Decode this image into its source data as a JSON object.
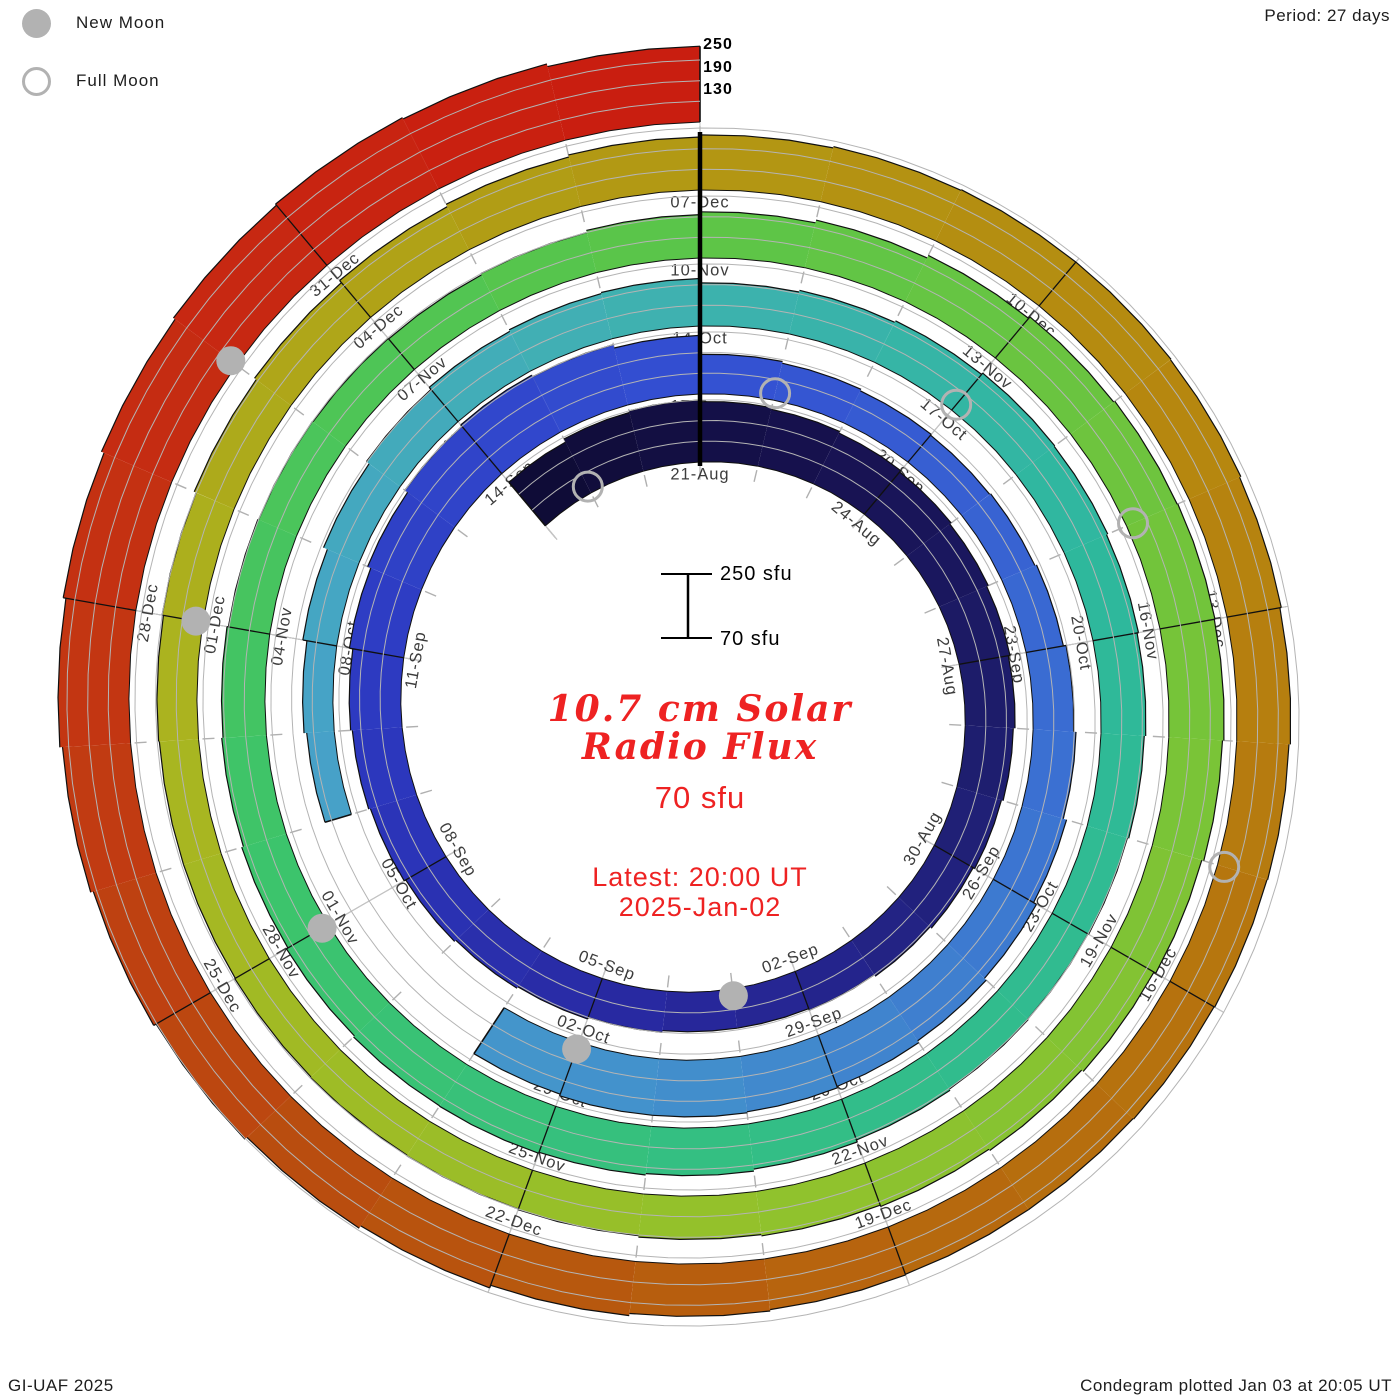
{
  "legend": {
    "new_moon": "New Moon",
    "full_moon": "Full Moon"
  },
  "period_label": "Period: 27 days",
  "credit": "GI-UAF 2025",
  "plotted": "Condegram plotted Jan 03 at 20:05 UT",
  "center": {
    "title_line1": "10.7 cm Solar",
    "title_line2": "Radio Flux",
    "current_value": "70 sfu",
    "latest_line1": "Latest: 20:00 UT",
    "latest_line2": "2025-Jan-02"
  },
  "scale_bar": {
    "top": "250 sfu",
    "bottom": "70 sfu"
  },
  "radial_axis_labels": [
    "250",
    "190",
    "130"
  ],
  "colors": {
    "accent_red_text": "#ee2222",
    "moon_gray": "#b2b2b2",
    "grid_gray": "#b4b4b4",
    "label_gray": "#3c3c3c"
  },
  "chart_data": {
    "type": "spiral",
    "subtype": "condegram",
    "title": "10.7 cm Solar Radio Flux",
    "period_days": 27,
    "start_date": "2024-08-18",
    "first_labeled_date": "2024-08-21",
    "end_date": "2025-01-02",
    "flux_axis": {
      "min": 70,
      "max": 250,
      "gridlines": [
        130,
        190,
        250
      ],
      "unit": "sfu"
    },
    "day_offset_of_first_value": -3,
    "flux_sfu": [
      235,
      245,
      250,
      245,
      240,
      235,
      230,
      225,
      220,
      215,
      210,
      205,
      200,
      195,
      190,
      185,
      185,
      190,
      195,
      200,
      205,
      210,
      215,
      220,
      230,
      240,
      250,
      255,
      250,
      240,
      185,
      180,
      175,
      172,
      175,
      180,
      188,
      195,
      205,
      215,
      222,
      228,
      232,
      235,
      235,
      230,
      null,
      null,
      null,
      150,
      158,
      170,
      182,
      192,
      200,
      205,
      208,
      195,
      200,
      205,
      210,
      208,
      204,
      200,
      196,
      192,
      190,
      192,
      196,
      202,
      208,
      212,
      215,
      214,
      210,
      205,
      200,
      196,
      192,
      190,
      188,
      186,
      190,
      196,
      204,
      212,
      220,
      226,
      230,
      232,
      230,
      226,
      220,
      214,
      208,
      204,
      200,
      196,
      192,
      190,
      188,
      186,
      184,
      184,
      186,
      190,
      196,
      202,
      210,
      218,
      224,
      230,
      234,
      236,
      236,
      234,
      230,
      226,
      222,
      220,
      218,
      216,
      216,
      218,
      222,
      228,
      236,
      244,
      252,
      260,
      268,
      276,
      284,
      292,
      298,
      302,
      298,
      290
    ],
    "date_labels": [
      {
        "day": 0,
        "text": "21-Aug"
      },
      {
        "day": 3,
        "text": "24-Aug"
      },
      {
        "day": 6,
        "text": "27-Aug"
      },
      {
        "day": 9,
        "text": "30-Aug"
      },
      {
        "day": 12,
        "text": "02-Sep"
      },
      {
        "day": 15,
        "text": "05-Sep"
      },
      {
        "day": 18,
        "text": "08-Sep"
      },
      {
        "day": 21,
        "text": "11-Sep"
      },
      {
        "day": 24,
        "text": "14-Sep"
      },
      {
        "day": 27,
        "text": "17-Sep"
      },
      {
        "day": 30,
        "text": "20-Sep"
      },
      {
        "day": 33,
        "text": "23-Sep"
      },
      {
        "day": 36,
        "text": "26-Sep"
      },
      {
        "day": 39,
        "text": "29-Sep"
      },
      {
        "day": 42,
        "text": "02-Oct"
      },
      {
        "day": 45,
        "text": "05-Oct"
      },
      {
        "day": 48,
        "text": "08-Oct"
      },
      {
        "day": 51,
        "text": "11-Oct"
      },
      {
        "day": 54,
        "text": "14-Oct"
      },
      {
        "day": 57,
        "text": "17-Oct"
      },
      {
        "day": 60,
        "text": "20-Oct"
      },
      {
        "day": 63,
        "text": "23-Oct"
      },
      {
        "day": 66,
        "text": "26-Oct"
      },
      {
        "day": 69,
        "text": "29-Oct"
      },
      {
        "day": 72,
        "text": "01-Nov"
      },
      {
        "day": 75,
        "text": "04-Nov"
      },
      {
        "day": 78,
        "text": "07-Nov"
      },
      {
        "day": 81,
        "text": "10-Nov"
      },
      {
        "day": 84,
        "text": "13-Nov"
      },
      {
        "day": 87,
        "text": "16-Nov"
      },
      {
        "day": 90,
        "text": "19-Nov"
      },
      {
        "day": 93,
        "text": "22-Nov"
      },
      {
        "day": 96,
        "text": "25-Nov"
      },
      {
        "day": 99,
        "text": "28-Nov"
      },
      {
        "day": 102,
        "text": "01-Dec"
      },
      {
        "day": 105,
        "text": "04-Dec"
      },
      {
        "day": 108,
        "text": "07-Dec"
      },
      {
        "day": 111,
        "text": "10-Dec"
      },
      {
        "day": 114,
        "text": "13-Dec"
      },
      {
        "day": 117,
        "text": "16-Dec"
      },
      {
        "day": 120,
        "text": "19-Dec"
      },
      {
        "day": 123,
        "text": "22-Dec"
      },
      {
        "day": 126,
        "text": "25-Dec"
      },
      {
        "day": 129,
        "text": "28-Dec"
      },
      {
        "day": 132,
        "text": "31-Dec"
      }
    ],
    "moons": [
      {
        "date": "2024-08-19",
        "type": "full",
        "day": -2
      },
      {
        "date": "2024-09-03",
        "type": "new",
        "day": 13
      },
      {
        "date": "2024-09-18",
        "type": "full",
        "day": 28
      },
      {
        "date": "2024-10-02",
        "type": "new",
        "day": 42
      },
      {
        "date": "2024-10-17",
        "type": "full",
        "day": 57
      },
      {
        "date": "2024-11-01",
        "type": "new",
        "day": 72
      },
      {
        "date": "2024-11-15",
        "type": "full",
        "day": 86
      },
      {
        "date": "2024-12-01",
        "type": "new",
        "day": 102
      },
      {
        "date": "2024-12-15",
        "type": "full",
        "day": 116
      },
      {
        "date": "2024-12-30",
        "type": "new",
        "day": 131
      }
    ],
    "color_stops": [
      {
        "day": -3,
        "color": "#0e0b34"
      },
      {
        "day": 2,
        "color": "#171250"
      },
      {
        "day": 8,
        "color": "#1f1f72"
      },
      {
        "day": 14,
        "color": "#28289e"
      },
      {
        "day": 20,
        "color": "#2c38c0"
      },
      {
        "day": 27,
        "color": "#3350d2"
      },
      {
        "day": 34,
        "color": "#3a6ed2"
      },
      {
        "day": 41,
        "color": "#4390cc"
      },
      {
        "day": 47,
        "color": "#47a2c8"
      },
      {
        "day": 53,
        "color": "#40b0b2"
      },
      {
        "day": 59,
        "color": "#2eb89e"
      },
      {
        "day": 66,
        "color": "#32bd88"
      },
      {
        "day": 73,
        "color": "#3dc46a"
      },
      {
        "day": 80,
        "color": "#58c54b"
      },
      {
        "day": 87,
        "color": "#74c43a"
      },
      {
        "day": 94,
        "color": "#92c22c"
      },
      {
        "day": 101,
        "color": "#aab520"
      },
      {
        "day": 107,
        "color": "#b29b14"
      },
      {
        "day": 113,
        "color": "#b6850f"
      },
      {
        "day": 119,
        "color": "#b66c0e"
      },
      {
        "day": 124,
        "color": "#b8500e"
      },
      {
        "day": 128,
        "color": "#c23812"
      },
      {
        "day": 131,
        "color": "#c62a12"
      },
      {
        "day": 134,
        "color": "#c91e10"
      }
    ]
  }
}
